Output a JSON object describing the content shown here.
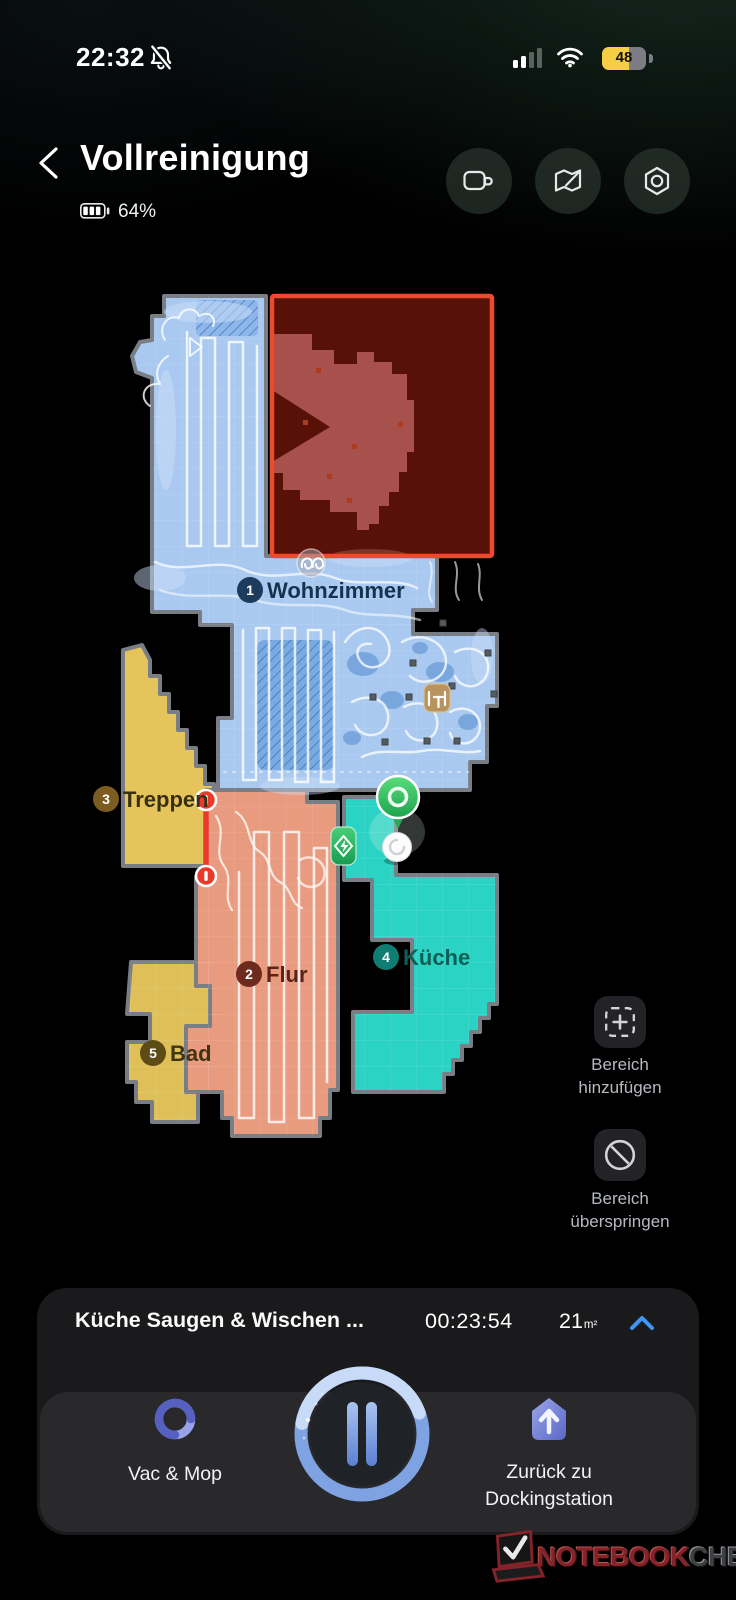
{
  "status_bar": {
    "time": "22:32",
    "battery_percent": "48"
  },
  "header": {
    "title": "Vollreinigung",
    "robot_battery": "64%"
  },
  "map": {
    "rooms": [
      {
        "number": "1",
        "name": "Wohnzimmer",
        "color": "#a9c9f0"
      },
      {
        "number": "2",
        "name": "Flur",
        "color": "#e99b80"
      },
      {
        "number": "3",
        "name": "Treppen",
        "color": "#e6c45c"
      },
      {
        "number": "4",
        "name": "Küche",
        "color": "#2bd3c5"
      },
      {
        "number": "5",
        "name": "Bad",
        "color": "#dfc058"
      }
    ],
    "zone_color": "#ea4a2d",
    "actions": [
      {
        "line1": "Bereich",
        "line2": "hinzufügen"
      },
      {
        "line1": "Bereich",
        "line2": "überspringen"
      }
    ]
  },
  "bottom_sheet": {
    "task_title": "Küche Saugen & Wischen ...",
    "elapsed_time": "00:23:54",
    "area_value": "21",
    "area_unit": "m²",
    "controls": {
      "vac_mop_label": "Vac & Mop",
      "dock_label_line1": "Zurück zu",
      "dock_label_line2": "Dockingstation"
    }
  },
  "watermark": {
    "brand_primary": "NOTEBOOK",
    "brand_secondary": "CHECK"
  },
  "colors": {
    "accent_blue": "#3f96f5",
    "pause_ring": "#86aae6",
    "battery_low_power_yellow": "#f6ce45",
    "dock_green": "#35c56d",
    "background": "#000000"
  },
  "icons": [
    "bell-slash-icon",
    "signal-icon",
    "wifi-icon",
    "battery-icon",
    "back-icon",
    "video-camera-icon",
    "map-edit-icon",
    "settings-nut-icon",
    "add-zone-icon",
    "skip-zone-icon",
    "chevron-up-icon",
    "vac-mop-swirl-icon",
    "pause-icon",
    "dock-home-icon",
    "robot-icon",
    "dock-pin-icon",
    "no-entry-icon",
    "furniture-icon",
    "carpet-squiggle-icon"
  ]
}
